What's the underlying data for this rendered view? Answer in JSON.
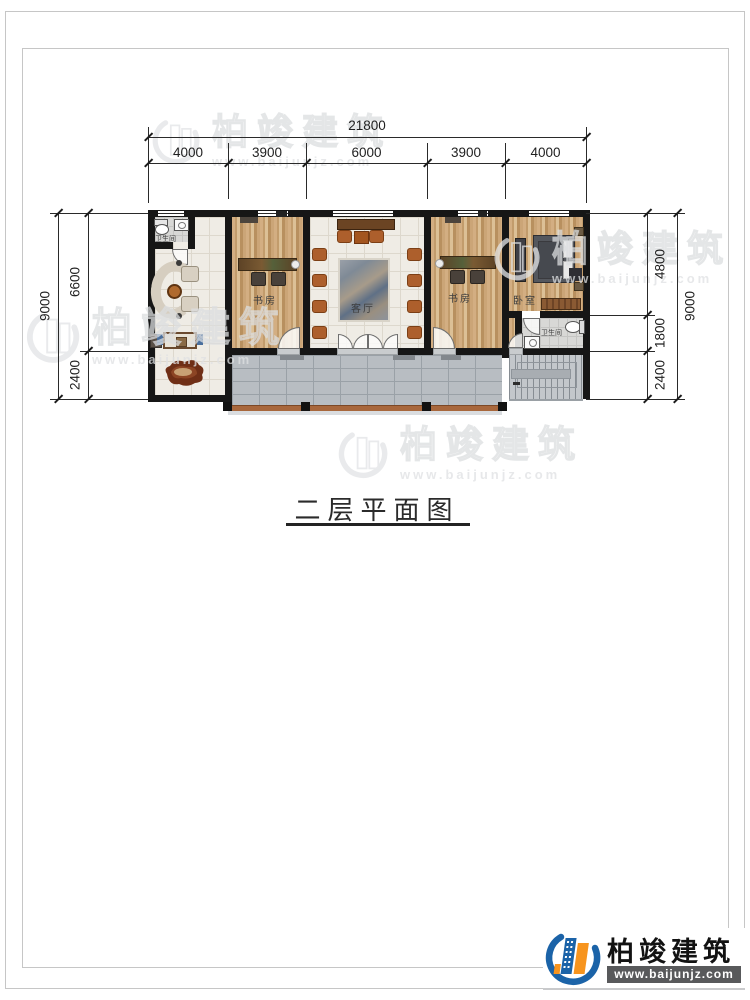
{
  "title": {
    "text": "二层平面图"
  },
  "dimensions": {
    "top": {
      "total": "21800",
      "segments": [
        "4000",
        "3900",
        "6000",
        "3900",
        "4000"
      ]
    },
    "left": {
      "total": "9000",
      "segments": [
        "6600",
        "2400"
      ]
    },
    "right": {
      "total": "9000",
      "segments": [
        "4800",
        "1800",
        "2400"
      ]
    }
  },
  "rooms": {
    "bathroom1": {
      "label": "卫生间"
    },
    "study1": {
      "label": "书房"
    },
    "living": {
      "label": "客厅"
    },
    "study2": {
      "label": "书房"
    },
    "bedroom": {
      "label": "卧室"
    },
    "bathroom2": {
      "label": "卫生间"
    }
  },
  "watermark": {
    "brand": "柏竣建筑",
    "url": "www.baijunjz.com"
  },
  "logo": {
    "brand": "柏竣建筑",
    "url": "www.baijunjz.com"
  },
  "colors": {
    "wall": "#161616",
    "wood_floor": "#c9a472",
    "tile_floor": "#efece5",
    "balcony": "#b8bdc2",
    "railing": "#a8673c",
    "logo_blue": "#1b63a8",
    "logo_orange": "#f7941e",
    "watermark_gray": "#dfe1e3"
  }
}
